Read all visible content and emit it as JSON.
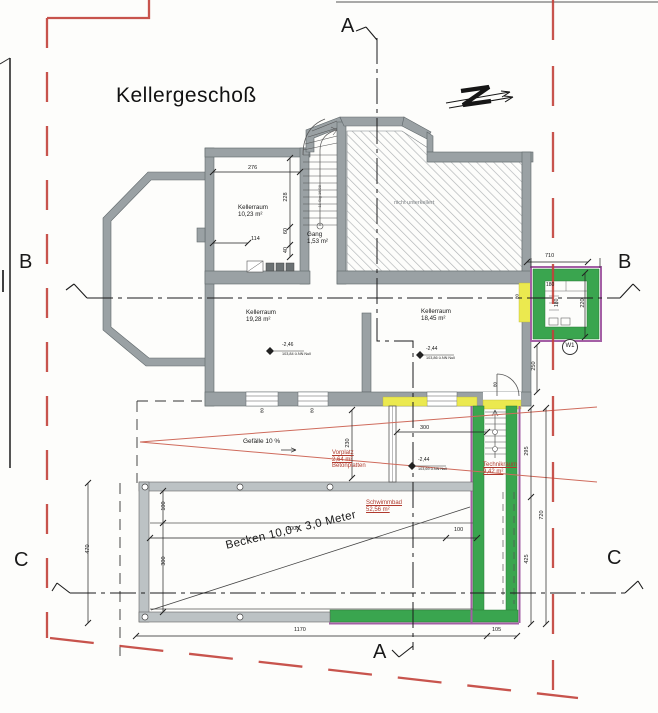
{
  "title": "Kellergeschoß",
  "section_marks": {
    "a": "A",
    "b": "B",
    "c": "C"
  },
  "north_icon": "Z",
  "rooms": {
    "kellerraum1": {
      "name": "Kellerraum",
      "area": "10,23 m²"
    },
    "kellerraum2": {
      "name": "Kellerraum",
      "area": "19,28 m²"
    },
    "kellerraum3": {
      "name": "Kellerraum",
      "area": "18,45 m²"
    },
    "gang": {
      "name": "Gang",
      "area": "1,53 m²"
    },
    "technikraum": {
      "name": "Technikraum",
      "area": "9,42 m²"
    },
    "vorplatz": {
      "name": "Vorplatz",
      "area": "2,64 m²",
      "note": "Betonplatten"
    },
    "schwimmbad": {
      "name": "Schwimmbad",
      "area": "52,56 m²"
    }
  },
  "annotations": {
    "existing_area": "nicht unterkellert",
    "slope": "Gefälle 10 %",
    "pool": "Becken 10,0 x 3,0 Meter",
    "stairs_note": "11 Stg 16/28",
    "window_mark": "W1"
  },
  "levels": {
    "left": {
      "value": "-2,46",
      "datum": "103,84 ü.NN Null"
    },
    "right": {
      "value": "-2,44",
      "datum": "103,86 ü.NN Null"
    },
    "outside": {
      "value": "-2,44",
      "datum": "103,69 ü.NN Null"
    }
  },
  "dimensions": {
    "room1_width": "276",
    "room1_depth": "228",
    "niche_width": "114",
    "d60": "60",
    "d40": "40",
    "shaft_total": "710",
    "shaft_inner_w": "180",
    "shaft_inner_h": "180",
    "shaft_depth": "220",
    "chain_250": "250",
    "chain_295": "295",
    "chain_720": "720",
    "chain_425": "425",
    "vorplatz_depth": "230",
    "paved_width": "300",
    "pool_deck_top": "100",
    "pool_width": "300",
    "pool_left": "470",
    "pool_length": "1000",
    "pool_deck_right": "100",
    "bottom_total": "1170",
    "bottom_shaft": "105",
    "win1": "80",
    "win2": "80",
    "door": "80",
    "opening": "80"
  },
  "colors": {
    "boundary_red": "#c2413a",
    "new_construction_green": "#3aa54f",
    "alteration_magenta": "#a45fa5",
    "demolition_yellow": "#ebe94f",
    "wall_grey": "#9aa1a4",
    "annotation_red": "#b03a2e"
  }
}
